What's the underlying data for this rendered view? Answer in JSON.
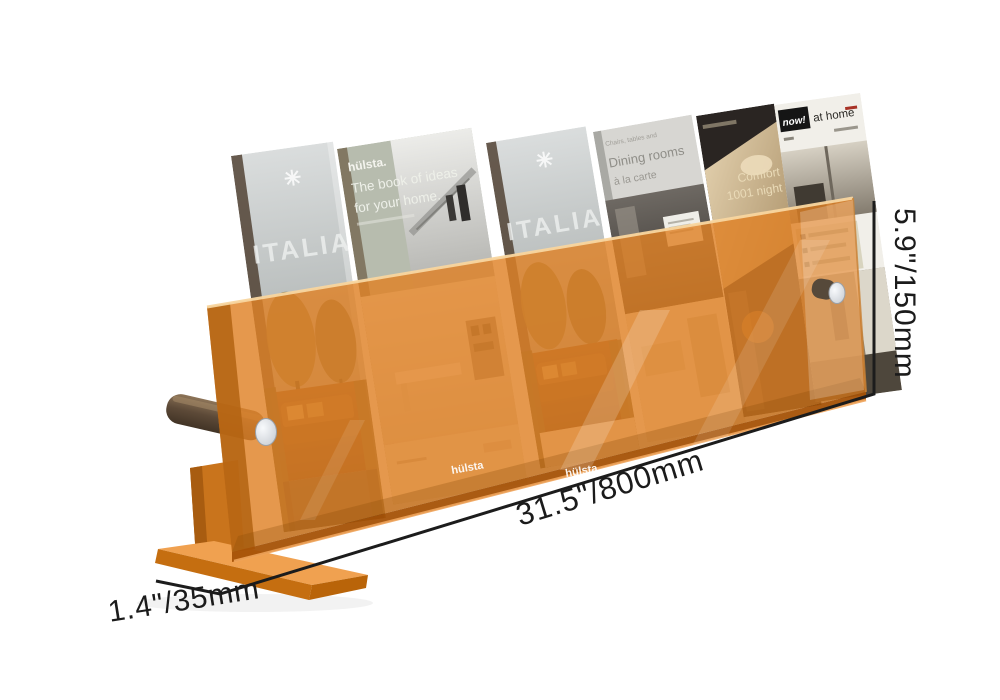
{
  "image": {
    "description": "Orange translucent acrylic magazine rack display holding six home furnishing catalogues, annotated with product dimensions",
    "background": "#ffffff"
  },
  "dimensions": {
    "length_label": "31.5\"/800mm",
    "height_label": "5.9\"/150mm",
    "depth_label": "1.4\"/35mm"
  },
  "magazines": [
    {
      "name": "italian-style-catalogue",
      "icon": "star",
      "title": "ITALIAN ST"
    },
    {
      "name": "hulsta-book-of-ideas",
      "brand": "hülsta.",
      "line1": "The book of ideas",
      "line2": "for your home.",
      "spine": "The book of ideas for your home"
    },
    {
      "name": "italian-style-catalogue-2",
      "icon": "star",
      "title": "ITALIAN ST"
    },
    {
      "name": "dining-rooms-catalogue",
      "kicker": "Chairs, tables and",
      "line1": "Dining rooms",
      "line2": "à la carte"
    },
    {
      "name": "comfort-catalogue",
      "line1": "Comfort",
      "line2": "1001 night"
    },
    {
      "name": "now-at-home-catalogue",
      "logo": "now!",
      "title": "at home"
    }
  ],
  "panel_logos": [
    {
      "text": "hülsta"
    },
    {
      "text": "hülsta"
    }
  ],
  "colors": {
    "acrylic_orange": "#DF8126",
    "acrylic_edge_dark": "#B36312",
    "base_orange": "#EFA04C",
    "rod_brown": "#5D4A38",
    "rod_cap_silver": "#E9EBEF",
    "dimension_line": "#1C1C1C"
  }
}
